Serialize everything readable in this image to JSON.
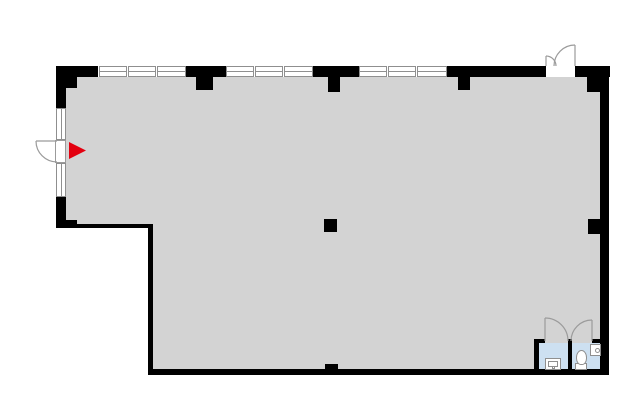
{
  "plan": {
    "kind": "architectural-floor-plan",
    "rooms": [
      "main-hall",
      "restroom-left",
      "restroom-right"
    ],
    "doors": [
      "entrance-west",
      "double-door-north-east",
      "restroom-left-door",
      "restroom-right-door"
    ],
    "window_bays_north": 3,
    "window_panes_per_bay": 3,
    "window_panes_west": 2,
    "columns": [
      "free-standing-column",
      "north-pilasters",
      "east-pilaster",
      "south-pilaster"
    ],
    "fixtures": [
      "sink",
      "toilet",
      "hand-basin"
    ],
    "entrance_marker": "red-triangle-pointing-east"
  },
  "colors": {
    "background": "#ffffff",
    "wall": "#000000",
    "floor": "#d3d3d3",
    "restroom-floor": "#cde0f1",
    "window-stroke": "#8f8f8f",
    "door-stroke": "#9b9b9b",
    "fixture-stroke": "#8f8f8f",
    "entrance-marker": "#e3000f"
  }
}
